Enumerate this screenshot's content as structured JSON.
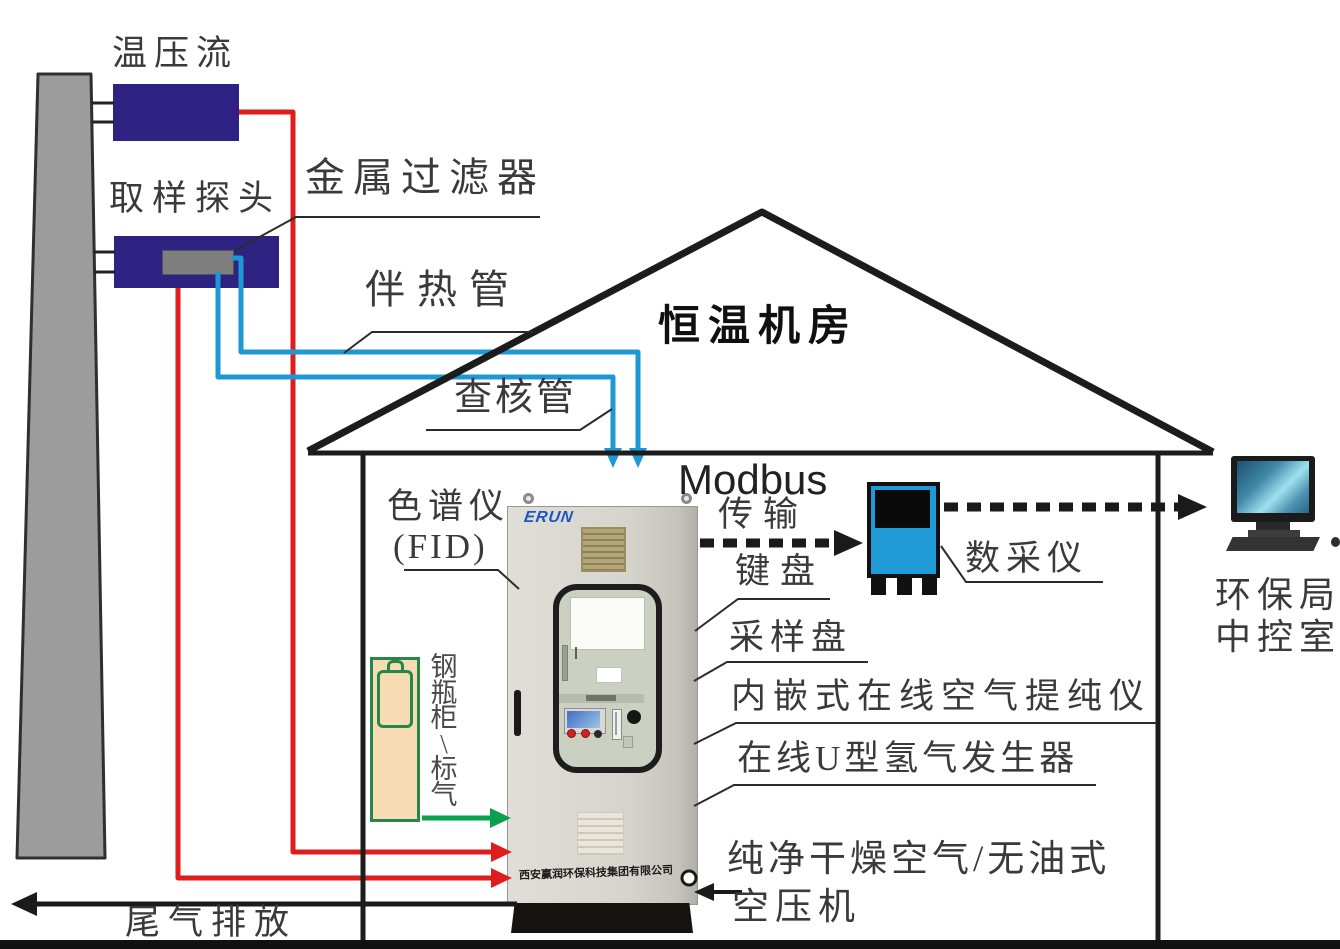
{
  "labels": {
    "temp_pressure_flow": "温压流",
    "sampling_probe": "取样探头",
    "metal_filter": "金属过滤器",
    "heated_tube": "伴热管",
    "check_tube": "查核管",
    "room": "恒温机房",
    "modbus": "Modbus",
    "transmission": "传输",
    "keyboard": "键盘",
    "sampling_plate": "采样盘",
    "daq": "数采仪",
    "air_purifier": "内嵌式在线空气提纯仪",
    "h2_generator": "在线U型氢气发生器",
    "chromatograph": "色谱仪",
    "fid": "(FID)",
    "dry_air": "纯净干燥空气/无油式",
    "compressor": "空压机",
    "exhaust": "尾气排放",
    "epa_line1": "环保局",
    "epa_line2": "中控室",
    "cylinder_chars": [
      "钢",
      "瓶",
      "柜",
      "\\",
      "标",
      "气"
    ],
    "company": "西安赢润环保科技集团有限公司",
    "logo": "ERUN"
  },
  "colors": {
    "navy": "#2e2382",
    "red": "#e01d1d",
    "blue": "#1e98d5",
    "green": "#0aa14e",
    "green2": "#27864a",
    "daqblue": "#1f9ad6",
    "cream": "#f6dbb3",
    "line": "#1c1c1c",
    "stack_gray": "#9c9c9c"
  }
}
